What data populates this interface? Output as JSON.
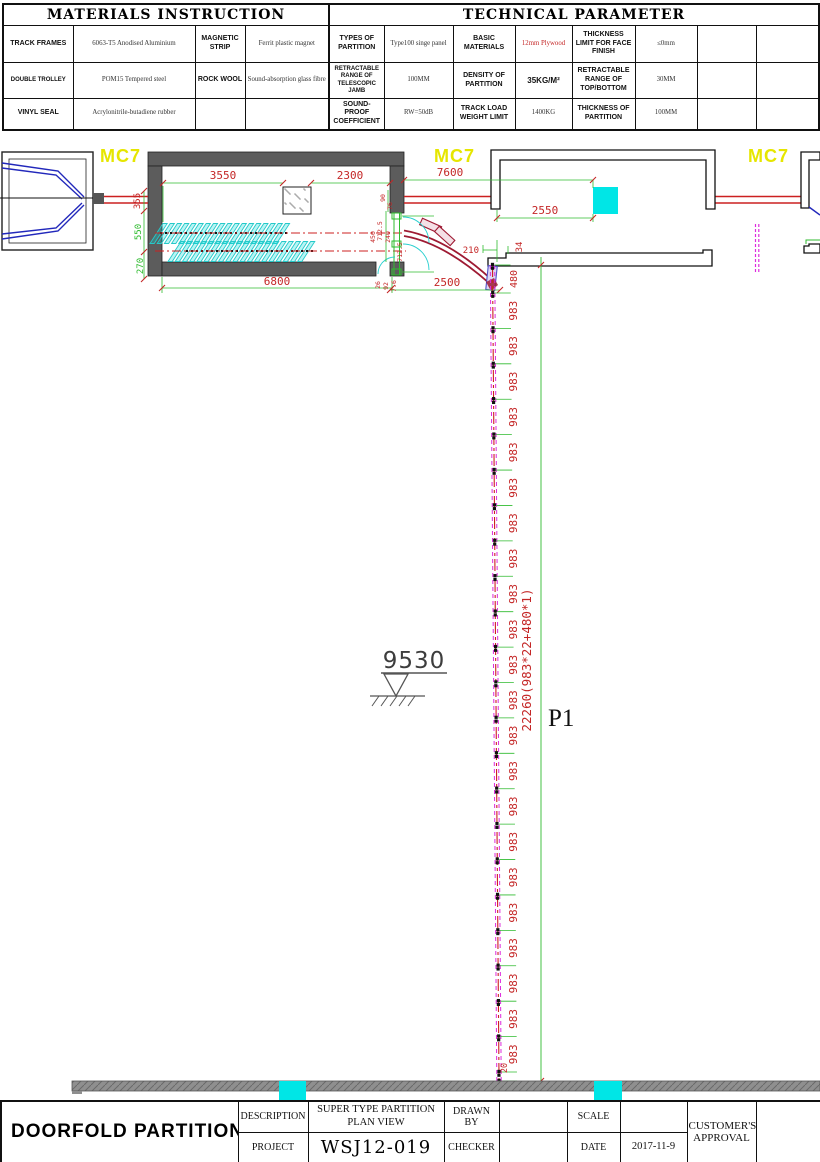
{
  "colors": {
    "dim_text": "#c42626",
    "dim_line": "#2fbb2f",
    "track_red": "#cc2020",
    "dark_red": "#9e1a33",
    "cyan": "#27cfcf",
    "cyan_fill": "#00e6e6",
    "magenta": "#dd2cdd",
    "yellow": "#e6e600",
    "wall_gray": "#5c5c5c",
    "blue": "#2228bb"
  },
  "top_tables": {
    "materials_title": "MATERIALS INSTRUCTION",
    "technical_title": "TECHNICAL PARAMETER",
    "rows": [
      {
        "c": [
          "TRACK FRAMES",
          "6063-T5 Anodised Aluminium",
          "MAGNETIC STRIP",
          "Ferrit plastic magnet",
          "TYPES OF PARTITION",
          "Type100 singe panel",
          "BASIC MATERIALS",
          "12mm Plywood",
          "THICKNESS LIMIT FOR FACE FINISH",
          "≤0mm",
          "",
          ""
        ]
      },
      {
        "c": [
          "DOUBLE TROLLEY",
          "POM15 Tempered steel",
          "ROCK WOOL",
          "Sound-absorption glass fibre",
          "RETRACTABLE RANGE OF TELESCOPIC JAMB",
          "100MM",
          "DENSITY OF PARTITION",
          "35KG/M²",
          "RETRACTABLE RANGE OF TOP/BOTTOM",
          "30MM",
          "",
          ""
        ]
      },
      {
        "c": [
          "VINYL SEAL",
          "Acrylonitrile-butadiene rubber",
          "",
          "",
          "SOUND-PROOF COEFFICIENT",
          "RW=50dB",
          "TRACK LOAD WEIGHT LIMIT",
          "1400KG",
          "THICKNESS OF PARTITION",
          "100MM",
          "",
          ""
        ]
      }
    ]
  },
  "drawing": {
    "mc7_left": "MC7",
    "mc7_mid": "MC7",
    "mc7_right": "MC7",
    "level_marker": "9530",
    "partition_tag": "P1",
    "dims": {
      "d3550": "3550",
      "d2300": "2300",
      "d6800": "6800",
      "d355": "355",
      "d550": "550",
      "d270": "270",
      "d7600": "7600",
      "d2550": "2550",
      "d2500": "2500",
      "d210": "210",
      "d34": "34",
      "d90": "90",
      "d76": "76",
      "d450": "450",
      "d712a": "712.5",
      "d240": "240",
      "d712b": "712.5",
      "d26": "26",
      "d92": "92",
      "d7_6": "7.6"
    },
    "run": {
      "top_dim": "480",
      "panel_dim": "983",
      "panel_count": 22,
      "bottom_dim": "20",
      "total_label": "22260(983*22+480*1)"
    }
  },
  "title_block": {
    "company": "DOORFOLD PARTITION",
    "logo_text": "DOORFOLD",
    "reg_mark": "®",
    "description_label": "DESCRIPTION",
    "description_value": "SUPER TYPE PARTITION PLAN VIEW",
    "project_label": "PROJECT",
    "project_value": "WSJ12-019",
    "drawn_by_label": "DRAWN BY",
    "drawn_by_value": "",
    "checker_label": "CHECKER",
    "checker_value": "",
    "scale_label": "SCALE",
    "scale_value": "",
    "date_label": "DATE",
    "date_value": "2017-11-9",
    "customer_label": "CUSTOMER'S APPROVAL"
  }
}
